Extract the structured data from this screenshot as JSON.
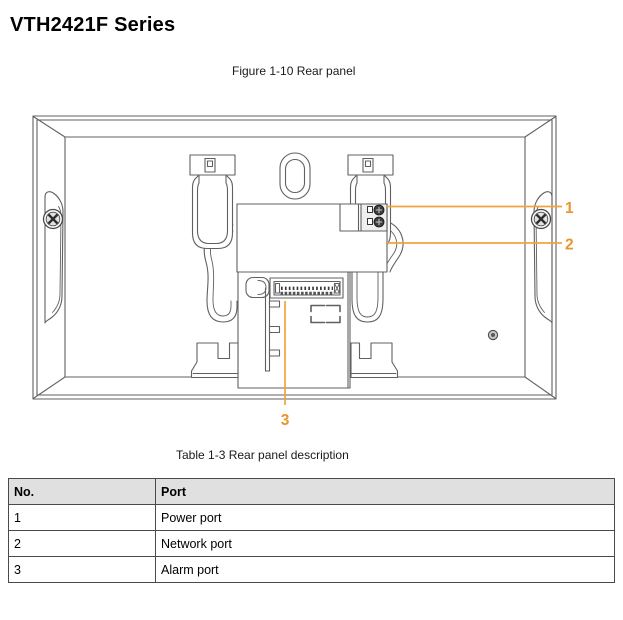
{
  "page": {
    "title": "VTH2421F Series"
  },
  "figure": {
    "caption": "Figure 1-10 Rear panel"
  },
  "diagram": {
    "callouts": [
      {
        "label": "1"
      },
      {
        "label": "2"
      },
      {
        "label": "3"
      }
    ]
  },
  "table": {
    "caption": "Table 1-3 Rear panel description",
    "headers": {
      "no": "No.",
      "port": "Port"
    },
    "rows": [
      {
        "no": "1",
        "port": "Power port"
      },
      {
        "no": "2",
        "port": "Network port"
      },
      {
        "no": "3",
        "port": "Alarm port"
      }
    ]
  },
  "colors": {
    "accent-line": "#F0A43C",
    "accent-text": "#E8952B",
    "diagram-line": "#606060",
    "table-header-bg": "#E0E0E0",
    "table-border": "#4A4A4A",
    "text": "#1A1A1A"
  }
}
